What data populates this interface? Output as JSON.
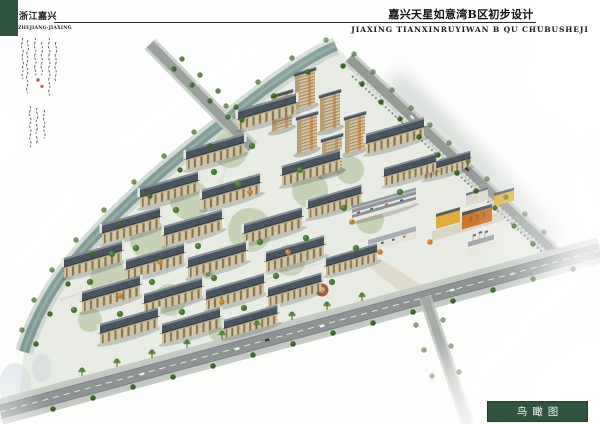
{
  "header": {
    "region_title_cn": "浙江嘉兴",
    "region_title_en": "ZHEJIANG·JIAXING",
    "project_title_cn": "嘉兴天星如意湾B区初步设计",
    "project_title_en": "JIAXING TIANXINRUYIWAN B QU CHUBUSHEJI"
  },
  "caption": {
    "view_label": "鸟瞰图"
  },
  "annotation": {
    "type": "handwritten-calligraphy-with-red-seals"
  },
  "colors": {
    "brand_green": "#2e5440",
    "seal_red": "#b03a28",
    "rule_line": "#2b2b2b",
    "wall_beige": "#d4c49f",
    "roof_slate": "#4a545e",
    "water_teal": "#7f9a94",
    "road_gray": "#8d9393",
    "tree_green": "#47762f",
    "palm_green": "#4e8038",
    "accent_yellow": "#e2ab3a",
    "accent_orange": "#cf7428"
  },
  "scene": {
    "view": "aerial-birds-eye-rendering",
    "elements": [
      "residential-slab-buildings",
      "high-rise-towers",
      "canal",
      "main-boulevard",
      "palm-lined-avenue",
      "side-roads",
      "street-trees",
      "kindergarten-block",
      "commercial-strip",
      "entrance-plaza"
    ]
  }
}
